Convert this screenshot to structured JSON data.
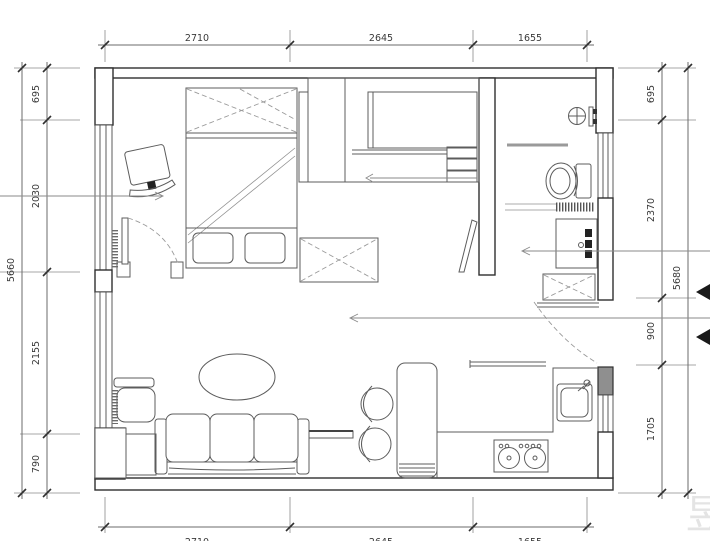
{
  "drawing": {
    "dimensions": {
      "top": [
        "2710",
        "2645",
        "1655"
      ],
      "bottom": [
        "2710",
        "2645",
        "1655"
      ],
      "left": [
        "695",
        "2030",
        "2155",
        "790"
      ],
      "left_total": "5660",
      "right": [
        "695",
        "2370",
        "900",
        "1705"
      ],
      "right_total": "5680"
    },
    "watermark": "昱"
  }
}
